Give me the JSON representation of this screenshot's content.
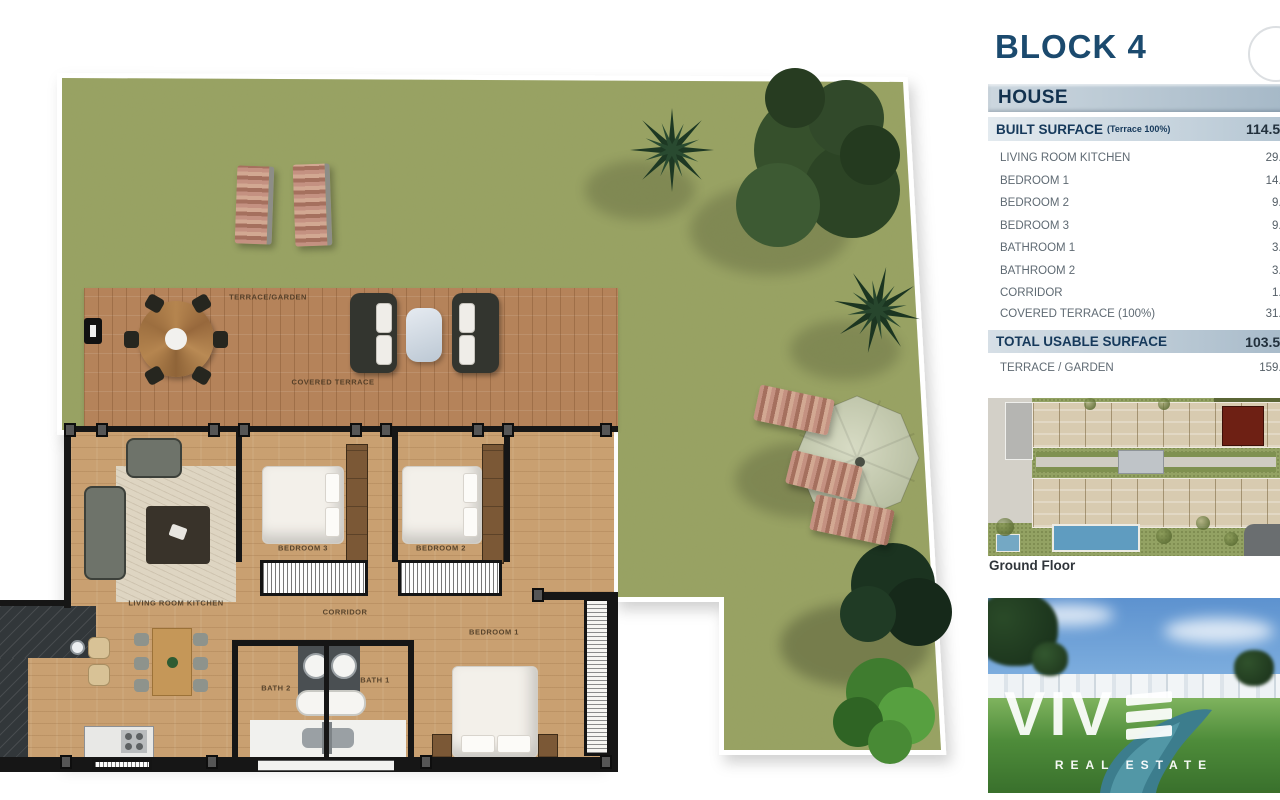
{
  "panel": {
    "block_title": "BLOCK 4",
    "house_header": "HOUSE",
    "built": {
      "label": "BUILT SURFACE",
      "sub": "(Terrace 100%)",
      "value": "114.50"
    },
    "rows": [
      {
        "label": "LIVING ROOM KITCHEN",
        "value": "29.8"
      },
      {
        "label": "BEDROOM 1",
        "value": "14.6"
      },
      {
        "label": "BEDROOM 2",
        "value": "9.7"
      },
      {
        "label": "BEDROOM 3",
        "value": "9.7"
      },
      {
        "label": "BATHROOM 1",
        "value": "3.8"
      },
      {
        "label": "BATHROOM 2",
        "value": "3.5"
      },
      {
        "label": "CORRIDOR",
        "value": "1.7"
      },
      {
        "label": "COVERED TERRACE (100%)",
        "value": "31.0"
      }
    ],
    "total": {
      "label": "TOTAL USABLE SURFACE",
      "value": "103.50"
    },
    "terrace_garden": {
      "label": "TERRACE / GARDEN",
      "value": "159.2"
    },
    "ground_floor_label": "Ground Floor"
  },
  "plan": {
    "labels": {
      "terrace_garden": "TERRACE/GARDEN",
      "covered_terrace": "COVERED TERRACE",
      "living": "LIVING ROOM KITCHEN",
      "bedroom3": "BEDROOM 3",
      "bedroom2": "BEDROOM 2",
      "bedroom1": "BEDROOM 1",
      "corridor": "CORRIDOR",
      "bath2": "BATH 2",
      "bath1": "BATH 1"
    }
  },
  "photo": {
    "brand": "VIV",
    "brand_sub": "REAL ESTATE"
  },
  "colors": {
    "accent_navy": "#16395b",
    "row_text_gray": "#5f6a73",
    "grass_green": "#99a263",
    "terrace_wood": "#b5835a",
    "interior_wood": "#c9a071",
    "highlight_unit_red": "#6e2014"
  }
}
